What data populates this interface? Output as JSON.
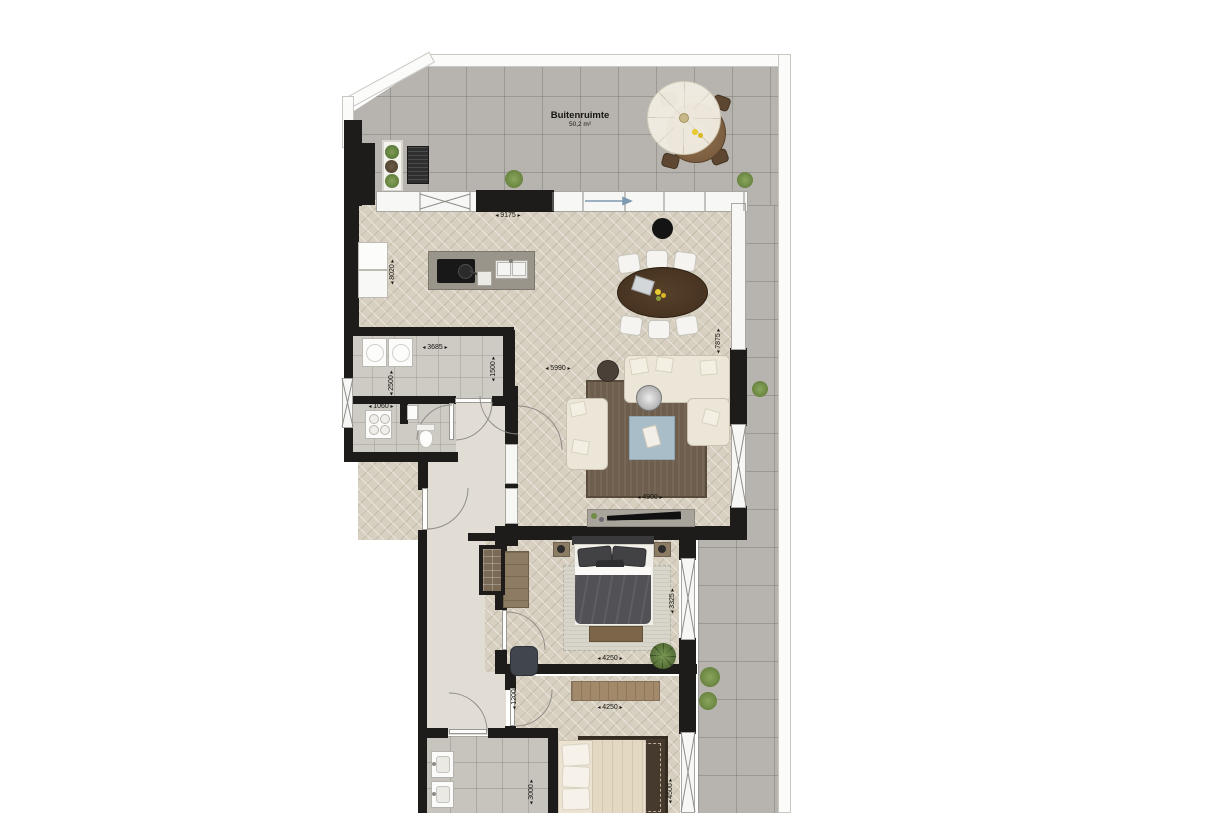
{
  "terrace": {
    "label": "Buitenruimte",
    "area": "50,2 m²"
  },
  "dimensions": {
    "living_width": "9175",
    "living_depth": "8020",
    "storage_width": "3685",
    "storage_depth": "2500",
    "niche_width": "1060",
    "storage_right": "1500",
    "lounge_width": "5990",
    "living_height": "7875",
    "tv_wall": "4900",
    "bedroom1_depth": "3325",
    "bedroom1_width": "4250",
    "bedroom2_width": "4250",
    "corridor_width": "1200",
    "bedroom2_depth": "4500",
    "bathroom_depth": "3000"
  },
  "colors": {
    "wall": "#1e1c1a",
    "wood_floor": "#d7d0c1",
    "terrace_tile": "#b7b4af",
    "bath_tile": "#c7c4be",
    "sofa": "#ece6d8",
    "living_rug": "#6d5e4d",
    "ottoman": "#a9bdc9",
    "dining_table": "#44311f",
    "bed_duvet": "#515156",
    "plant_green": "#6f8c44"
  }
}
